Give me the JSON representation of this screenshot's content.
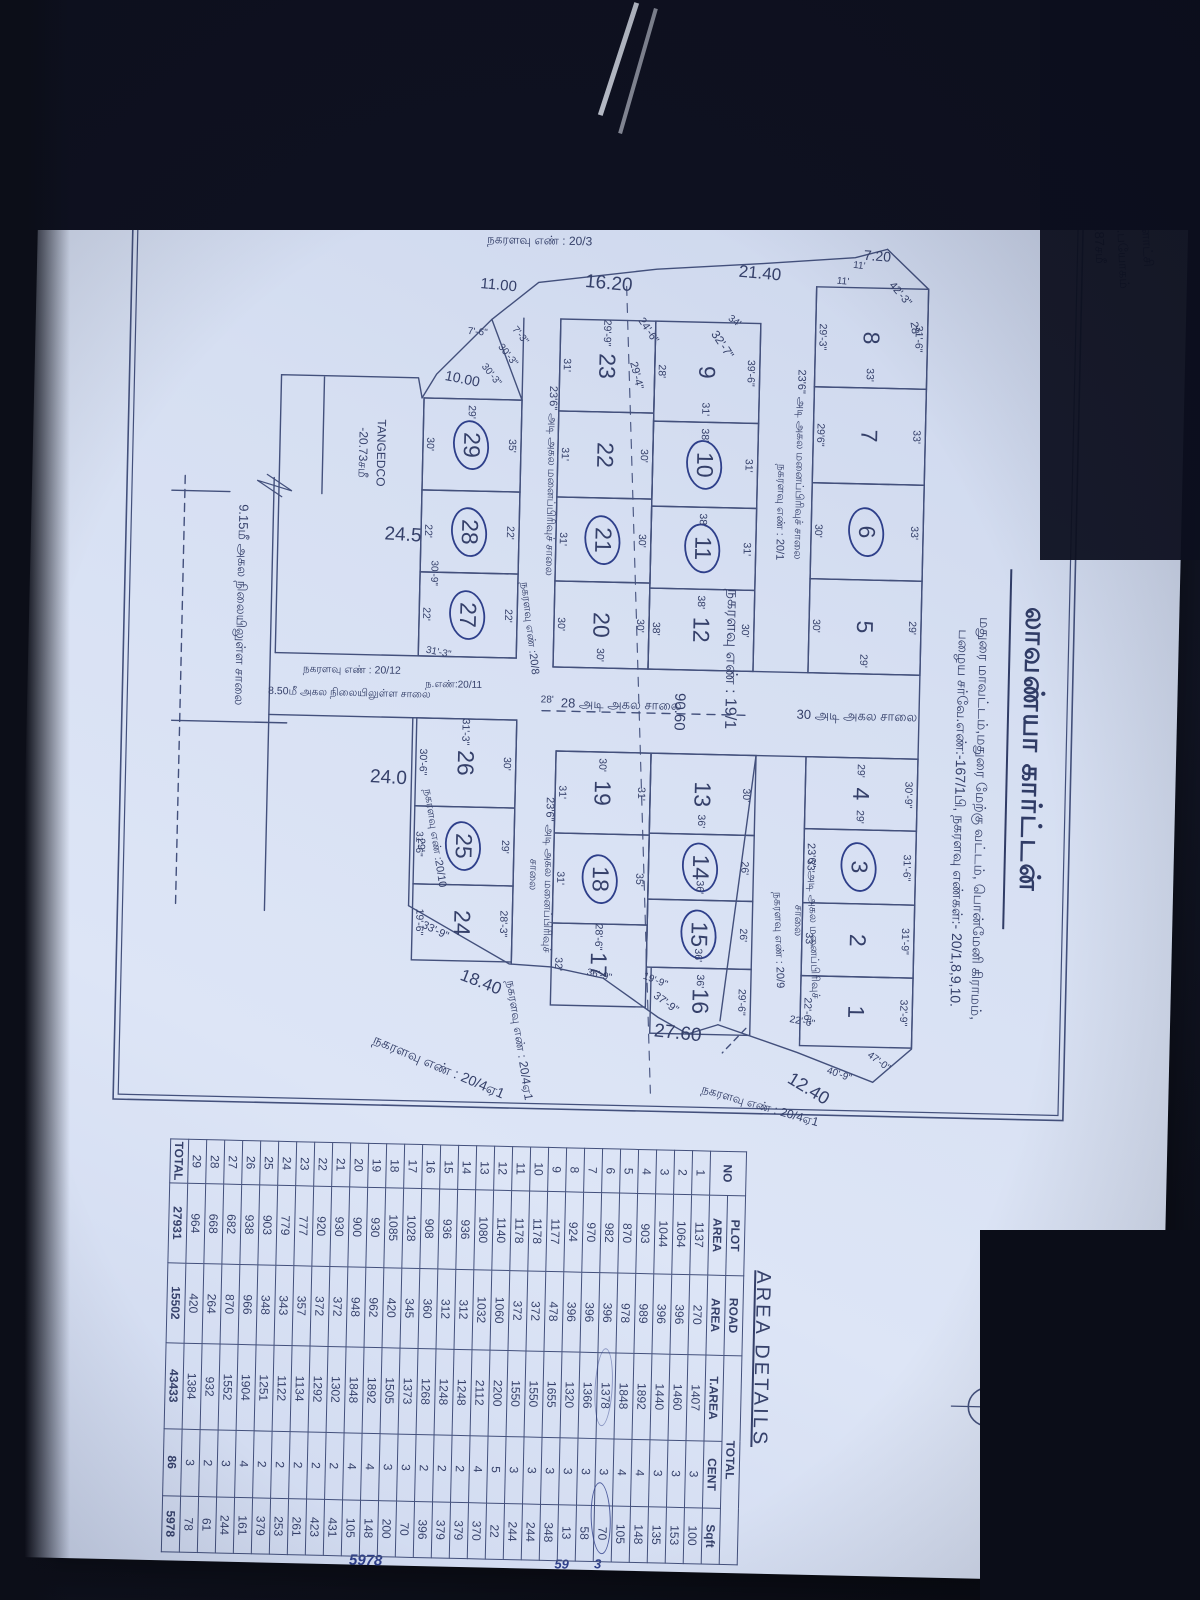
{
  "colors": {
    "paper": "#d6dff2",
    "ink": "#35406a",
    "background": "#10131f",
    "handwriting": "#2e3f8a"
  },
  "header": {
    "title": "லாவண்யா கார்ட்டன்",
    "subtitle1": "மதுரை மாவட்டம்,மதுரை மேற்கு வட்டம், பொன்மேனி கிராமம்,",
    "subtitle2": "பழைய சர்வே.எண்:-167/1பி, நகரளவு எண்கள்:- 20/1,8,9,10.",
    "compass_letter": "வ"
  },
  "corner_note": {
    "line1": "உ.ளாட்சி",
    "line2": "உ.பயோகம்",
    "line3": "-22.87சமீ"
  },
  "plan": {
    "plots": [
      [
        "8",
        252,
        258,
        100,
        112,
        0,
        "31'-6\"",
        "29'-3\"",
        "",
        "33'"
      ],
      [
        "7",
        352,
        258,
        96,
        112,
        0,
        "33'",
        "29'6\"",
        "",
        ""
      ],
      [
        "6",
        448,
        258,
        96,
        112,
        1,
        "33'",
        "30'",
        "",
        ""
      ],
      [
        "5",
        544,
        258,
        94,
        112,
        0,
        "29'",
        "30'",
        "",
        "29'"
      ],
      [
        "4",
        722,
        258,
        72,
        112,
        0,
        "30'-9\"",
        "",
        "29'",
        "29'"
      ],
      [
        "3",
        794,
        258,
        74,
        112,
        1,
        "31'-6\"",
        "33'",
        "",
        ""
      ],
      [
        "2",
        868,
        258,
        73,
        112,
        0,
        "31'-9\"",
        "33'",
        "",
        ""
      ],
      [
        "1",
        941,
        258,
        70,
        112,
        0,
        "32'-9\"",
        "22'-6\"",
        "",
        ""
      ],
      [
        "9",
        290,
        425,
        100,
        105,
        0,
        "39'-6\"",
        "28'",
        "",
        "31'"
      ],
      [
        "10",
        390,
        425,
        85,
        105,
        1,
        "31'",
        "",
        "38'",
        ""
      ],
      [
        "11",
        475,
        425,
        82,
        105,
        1,
        "31'",
        "",
        "38'",
        ""
      ],
      [
        "12",
        557,
        425,
        81,
        105,
        0,
        "30'",
        "38'",
        "38'",
        ""
      ],
      [
        "13",
        722,
        420,
        80,
        105,
        0,
        "30'",
        "",
        "",
        "36'"
      ],
      [
        "14",
        802,
        420,
        66,
        105,
        1,
        "26'",
        "",
        "",
        "36'"
      ],
      [
        "15",
        868,
        420,
        68,
        105,
        1,
        "26'",
        "",
        "",
        "36'"
      ],
      [
        "16",
        936,
        420,
        66,
        100,
        0,
        "29'-6\"",
        "",
        "36'",
        ""
      ],
      [
        "23",
        290,
        530,
        92,
        95,
        0,
        "",
        "31'",
        "29'-9\"",
        ""
      ],
      [
        "22",
        382,
        530,
        86,
        95,
        0,
        "30'",
        "31'",
        "",
        ""
      ],
      [
        "21",
        468,
        530,
        84,
        95,
        1,
        "30'",
        "31'",
        "",
        ""
      ],
      [
        "20",
        552,
        530,
        86,
        95,
        0,
        "30'",
        "30'",
        "",
        "30'"
      ],
      [
        "19",
        722,
        525,
        82,
        95,
        0,
        "31'",
        "31'",
        "30'",
        ""
      ],
      [
        "18",
        804,
        525,
        90,
        95,
        1,
        "35'",
        "31'",
        "",
        ""
      ],
      [
        "17",
        894,
        525,
        82,
        95,
        0,
        "",
        "32'",
        "28'-6\"",
        ""
      ],
      [
        "29",
        372,
        662,
        92,
        98,
        1,
        "35'",
        "30'",
        "29'",
        ""
      ],
      [
        "28",
        464,
        662,
        82,
        98,
        1,
        "22'",
        "22'",
        "",
        ""
      ],
      [
        "27",
        546,
        662,
        84,
        98,
        1,
        "22'",
        "22'",
        "",
        ""
      ],
      [
        "26",
        692,
        660,
        88,
        100,
        0,
        "30'",
        "30'-6\"",
        "31'-3\"",
        ""
      ],
      [
        "25",
        780,
        660,
        78,
        100,
        1,
        "29'",
        "29'",
        "",
        ""
      ],
      [
        "24",
        858,
        660,
        76,
        100,
        0,
        "28'-3\"",
        "19'-6\"",
        "",
        ""
      ]
    ],
    "labels": [
      [
        "28'",
        292,
        272,
        11,
        -10,
        ""
      ],
      [
        "42'-3\"",
        258,
        287,
        11,
        -42,
        ""
      ],
      [
        "11'",
        231,
        328,
        10,
        -85,
        ""
      ],
      [
        "11'",
        247,
        344,
        10,
        -85,
        ""
      ],
      [
        "7.20",
        220,
        310,
        14,
        -87,
        ""
      ],
      [
        "நகரளவு எண் : 20/2",
        186,
        352,
        12,
        -90,
        ""
      ],
      [
        "21.40",
        240,
        427,
        17,
        -86,
        ""
      ],
      [
        "34'",
        289,
        452,
        10,
        -55,
        ""
      ],
      [
        "32'-7\"",
        312,
        463,
        12,
        -35,
        ""
      ],
      [
        "24'-6\"",
        300,
        538,
        11,
        -35,
        ""
      ],
      [
        "29'-4\"",
        345,
        549,
        11,
        -15,
        ""
      ],
      [
        "16.20",
        254,
        578,
        19,
        -86,
        ""
      ],
      [
        "நகரளவு எண் : 20/3",
        212,
        648,
        12,
        -90,
        ""
      ],
      [
        "11.00",
        258,
        688,
        15,
        -86,
        ""
      ],
      [
        "7'-3\"",
        308,
        666,
        10,
        -40,
        ""
      ],
      [
        "30'-3\"",
        328,
        678,
        10,
        -40,
        ""
      ],
      [
        "30'-3\"",
        348,
        694,
        10,
        -40,
        ""
      ],
      [
        "7'-6\"",
        306,
        708,
        10,
        -86,
        ""
      ],
      [
        "10.00",
        352,
        722,
        14,
        -80,
        ""
      ],
      [
        "24.5",
        510,
        778,
        19,
        -88,
        ""
      ],
      [
        "TANGEDCO",
        428,
        802,
        12,
        0,
        ""
      ],
      [
        "-20.73சமீ",
        428,
        820,
        12,
        0,
        ""
      ],
      [
        "24.0",
        753,
        787,
        19,
        -88,
        ""
      ],
      [
        "18.40",
        955,
        690,
        17,
        -70,
        ""
      ],
      [
        "33'-9\"",
        905,
        737,
        11,
        -65,
        ""
      ],
      [
        "30'-9\"",
        547,
        747,
        10,
        0,
        ""
      ],
      [
        "31'-3\"",
        627,
        740,
        10,
        -80,
        ""
      ],
      [
        "31'-6\"",
        818,
        756,
        10,
        0,
        ""
      ],
      [
        "நகரளவு எண் :20/10",
        812,
        740,
        11,
        -10,
        ""
      ],
      [
        "ந.எண்:20/11",
        659,
        724,
        10,
        -90,
        ""
      ],
      [
        "நகரளவு எண் : 20/12",
        646,
        826,
        10.5,
        -90,
        ""
      ],
      [
        "8.50மீ அகல நிலையிலுள்ள சாலை",
        669,
        828,
        10.5,
        -90,
        ""
      ],
      [
        "9.15மீ அகல நிலையிலுள்ள சாலை",
        583,
        938,
        13,
        0,
        ""
      ],
      [
        "30 அடி அகல சாலை",
        680,
        320,
        13,
        -90,
        ""
      ],
      [
        "28 அடி அகல சாலை",
        674,
        556,
        13,
        -90,
        ""
      ],
      [
        "90.60",
        680,
        498,
        15,
        0,
        ""
      ],
      [
        "நகரளவு எண் : 19/1",
        626,
        448,
        16,
        0,
        ""
      ],
      [
        "23'6\" அடி அகல மனைப்பிரிவுச் சாலை",
        430,
        384,
        11,
        0,
        ""
      ],
      [
        "நகரளவு எண் : 20/1",
        478,
        402,
        11,
        0,
        ""
      ],
      [
        "23'6\" அடி அகல மனைப்பிரிவுச்",
        886,
        360,
        11,
        -3,
        ""
      ],
      [
        "சாலை",
        886,
        375,
        11,
        0,
        ""
      ],
      [
        "நகரளவு எண் : 20/9",
        906,
        394,
        11,
        -3,
        ""
      ],
      [
        "23'6\" அடி அகல மனைப்பிரிவுச் சாலை",
        452,
        632,
        11,
        0,
        ""
      ],
      [
        "நகரளவு எண் :20/8",
        600,
        650,
        11,
        -8,
        ""
      ],
      [
        "23'6\" அடி அகல மனைப்பிரிவுச்",
        846,
        626,
        11,
        0,
        ""
      ],
      [
        "சாலை",
        846,
        641,
        11,
        0,
        ""
      ],
      [
        "28'",
        672,
        630,
        10,
        -90,
        ""
      ],
      [
        "22'-6\"",
        988,
        368,
        10,
        -80,
        ""
      ],
      [
        "47'-0\"",
        1026,
        291,
        10,
        -55,
        ""
      ],
      [
        "40'-9\"",
        1040,
        330,
        10,
        -72,
        ""
      ],
      [
        "12.40",
        1054,
        360,
        18,
        -60,
        ""
      ],
      [
        "27.60",
        1002,
        492,
        19,
        -85,
        ""
      ],
      [
        "37'-9\"",
        972,
        505,
        11,
        -55,
        ""
      ],
      [
        "19'-9\"",
        950,
        516,
        10,
        -70,
        ""
      ],
      [
        "36'-9\"",
        946,
        572,
        10,
        -78,
        ""
      ],
      [
        "நகரளவு எண் : 20/4ஏ1",
        1012,
        650,
        12,
        -10,
        ""
      ],
      [
        "நகரளவு எண் : 20/4ஏ1",
        1040,
        730,
        14,
        -68,
        ""
      ],
      [
        "நகரளவு எண் : 20/4ஏ1",
        1072,
        408,
        12,
        -75,
        ""
      ],
      [
        "5978",
        1536,
        792,
        15,
        -90,
        "hw"
      ],
      [
        "3",
        1534,
        560,
        13,
        -90,
        "hw"
      ],
      [
        "59",
        1535,
        596,
        13,
        -90,
        "hw"
      ]
    ]
  },
  "table": {
    "title": "AREA DETAILS",
    "header_no": "NO",
    "group_headers": [
      "PLOT",
      "ROAD",
      "TOTAL"
    ],
    "sub_headers": [
      "AREA",
      "AREA",
      "T.AREA",
      "CENT",
      "Sqft"
    ],
    "rows": [
      [
        "1",
        "1137",
        "270",
        "1407",
        "3",
        "100"
      ],
      [
        "2",
        "1064",
        "396",
        "1460",
        "3",
        "153"
      ],
      [
        "3",
        "1044",
        "396",
        "1440",
        "3",
        "135"
      ],
      [
        "4",
        "903",
        "989",
        "1892",
        "4",
        "148"
      ],
      [
        "5",
        "870",
        "978",
        "1848",
        "4",
        "105"
      ],
      [
        "6",
        "982",
        "396",
        "1378",
        "3",
        "70"
      ],
      [
        "7",
        "970",
        "396",
        "1366",
        "3",
        "58"
      ],
      [
        "8",
        "924",
        "396",
        "1320",
        "3",
        "13"
      ],
      [
        "9",
        "1177",
        "478",
        "1655",
        "3",
        "348"
      ],
      [
        "10",
        "1178",
        "372",
        "1550",
        "3",
        "244"
      ],
      [
        "11",
        "1178",
        "372",
        "1550",
        "3",
        "244"
      ],
      [
        "12",
        "1140",
        "1060",
        "2200",
        "5",
        "22"
      ],
      [
        "13",
        "1080",
        "1032",
        "2112",
        "4",
        "370"
      ],
      [
        "14",
        "936",
        "312",
        "1248",
        "2",
        "379"
      ],
      [
        "15",
        "936",
        "312",
        "1248",
        "2",
        "379"
      ],
      [
        "16",
        "908",
        "360",
        "1268",
        "2",
        "396"
      ],
      [
        "17",
        "1028",
        "345",
        "1373",
        "3",
        "70"
      ],
      [
        "18",
        "1085",
        "420",
        "1505",
        "3",
        "200"
      ],
      [
        "19",
        "930",
        "962",
        "1892",
        "4",
        "148"
      ],
      [
        "20",
        "900",
        "948",
        "1848",
        "4",
        "105"
      ],
      [
        "21",
        "930",
        "372",
        "1302",
        "2",
        "431"
      ],
      [
        "22",
        "920",
        "372",
        "1292",
        "2",
        "423"
      ],
      [
        "23",
        "777",
        "357",
        "1134",
        "2",
        "261"
      ],
      [
        "24",
        "779",
        "343",
        "1122",
        "2",
        "253"
      ],
      [
        "25",
        "903",
        "348",
        "1251",
        "2",
        "379"
      ],
      [
        "26",
        "938",
        "966",
        "1904",
        "4",
        "161"
      ],
      [
        "27",
        "682",
        "870",
        "1552",
        "3",
        "244"
      ],
      [
        "28",
        "668",
        "264",
        "932",
        "2",
        "61"
      ],
      [
        "29",
        "964",
        "420",
        "1384",
        "3",
        "78"
      ]
    ],
    "total_row": [
      "TOTAL",
      "27931",
      "15502",
      "43433",
      "86",
      "5978"
    ]
  }
}
